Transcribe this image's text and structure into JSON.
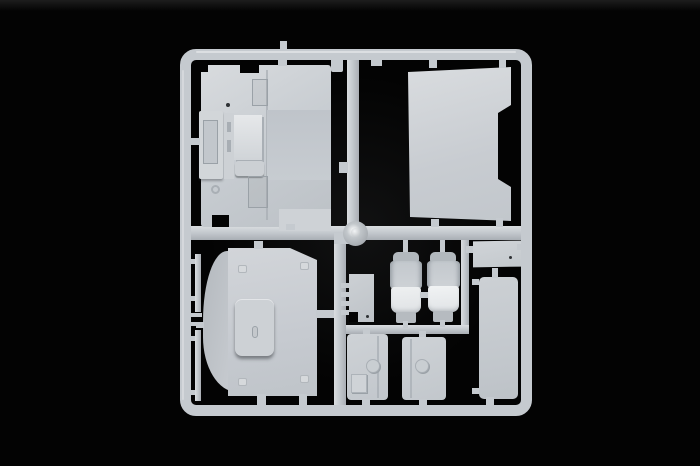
{
  "scene": {
    "subject": "plastic model kit parts sprue",
    "material": "light gray injection-molded styrene",
    "background": "black studio backdrop"
  },
  "colors": {
    "bg": "#030303",
    "top_haze": "#1d1d1d",
    "plastic": "#c5cacf",
    "plastic_light": "#dadde0",
    "plastic_dark": "#a9aeb4",
    "plastic_bright": "#eef0f1",
    "recess_shadow": "#9aa1a7",
    "pin_mark_dark": "#2e3134"
  },
  "parts": {
    "frame": "sprue frame runner",
    "center_gate": "central injection gate disc",
    "cab_floor": "cab floor with engine tunnel",
    "back_panel": "cab back wall panel",
    "roof_panel": "cab roof panel with sunroof hatch",
    "trim_strip_upper": "thin trim strip upper",
    "trim_strip_lower": "thin trim strip lower",
    "seat_left": "driver seat",
    "seat_right": "passenger seat",
    "step_grille": "step grille plate",
    "shelf_panel": "small shelf panel",
    "side_fairing": "tall side fairing panel",
    "door_left": "lower panel with hatch and filler cap",
    "door_right": "lower panel with filler cap"
  }
}
